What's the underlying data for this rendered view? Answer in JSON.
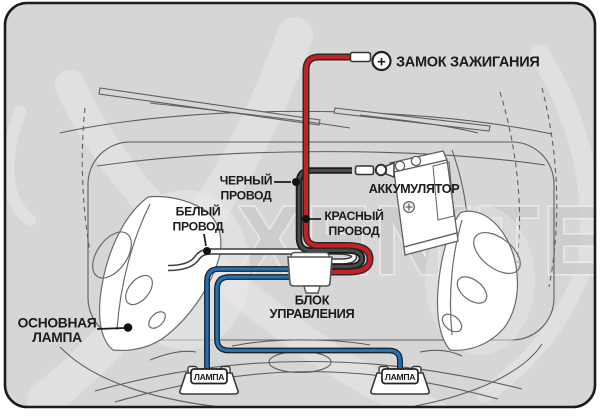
{
  "watermark": {
    "text": "XENITE"
  },
  "labels": {
    "ignition": "ЗАМОК ЗАЖИГАНИЯ",
    "battery": "АККУМУЛЯТОР",
    "black_wire": [
      "ЧЕРНЫЙ",
      "ПРОВОД"
    ],
    "white_wire": [
      "БЕЛЫЙ",
      "ПРОВОД"
    ],
    "red_wire": [
      "КРАСНЫЙ",
      "ПРОВОД"
    ],
    "control_unit": [
      "БЛОК",
      "УПРАВЛЕНИЯ"
    ],
    "main_lamp": [
      "ОСНОВНАЯ",
      "ЛАМПА"
    ],
    "lamp_left": "ЛАМПА",
    "lamp_right": "ЛАМПА",
    "plus_sign": "+"
  },
  "colors": {
    "background": "#D6D6D6",
    "border": "#1C1C1C",
    "red_wire": "#C92025",
    "blue_wire": "#2173B8",
    "black_wire": "#4A4A4A",
    "white_wire": "#FFFFFF",
    "label_text": "#1B1B1B",
    "watermark": "#CBCBCB"
  }
}
